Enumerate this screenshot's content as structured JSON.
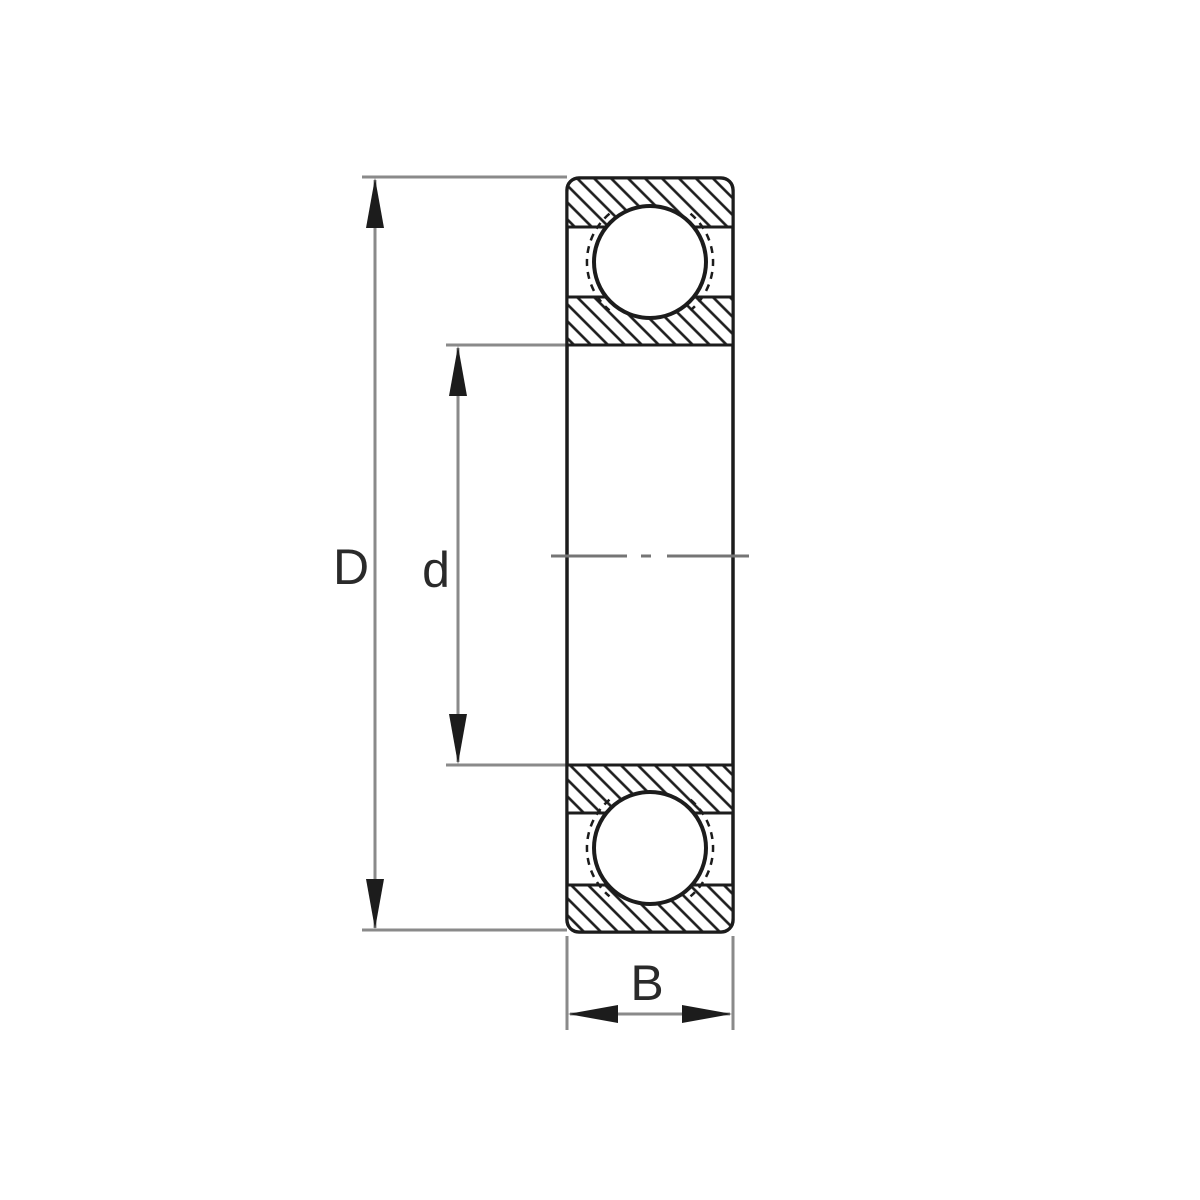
{
  "figure": {
    "labels": {
      "outer_diameter": "D",
      "bore_diameter": "d",
      "width": "B"
    }
  },
  "colors": {
    "background": "#ffffff",
    "ink": "#1c1c1c",
    "dim": "#8a8a8a",
    "centerline": "#757575",
    "label": "#2a2a2a"
  }
}
